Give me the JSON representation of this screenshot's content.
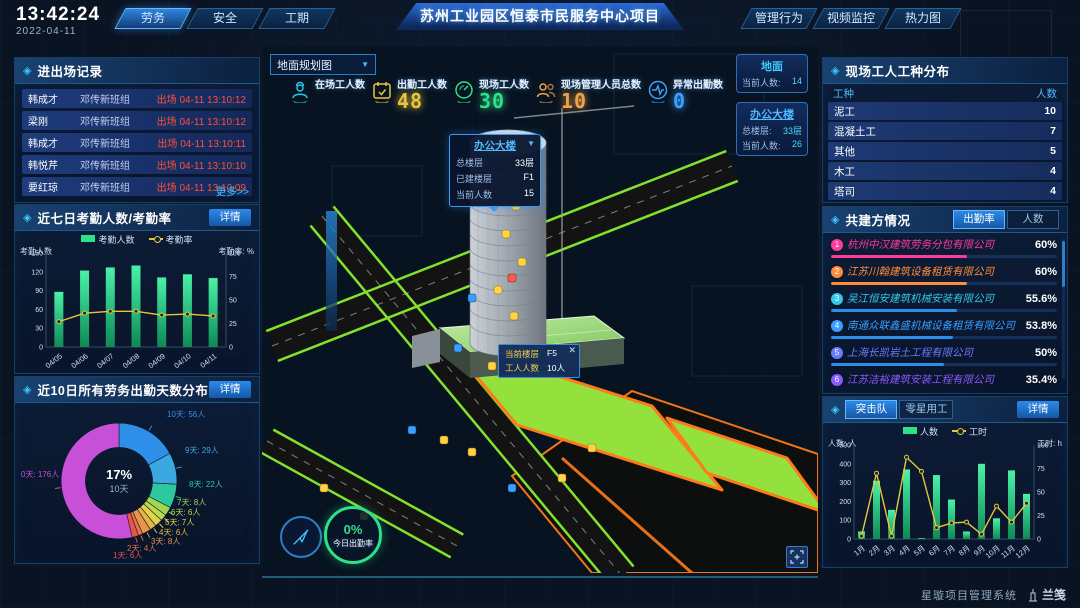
{
  "header": {
    "time": "13:42:24",
    "date": "2022-04-11",
    "left_tabs": [
      {
        "label": "劳务",
        "active": true
      },
      {
        "label": "安全",
        "active": false
      },
      {
        "label": "工期",
        "active": false
      }
    ],
    "title": "苏州工业园区恒泰市民服务中心项目",
    "right_tabs": [
      {
        "label": "管理行为"
      },
      {
        "label": "视频监控"
      },
      {
        "label": "热力图"
      }
    ]
  },
  "ui": {
    "detail_label": "详情"
  },
  "entry_exit": {
    "title": "进出场记录",
    "rows": [
      {
        "name": "韩成才",
        "group": "邓传新班组",
        "status": "出场 04-11 13:10:12"
      },
      {
        "name": "梁刚",
        "group": "邓传新班组",
        "status": "出场 04-11 13:10:12"
      },
      {
        "name": "韩成才",
        "group": "邓传新班组",
        "status": "出场 04-11 13:10:11"
      },
      {
        "name": "韩悦芹",
        "group": "邓传新班组",
        "status": "出场 04-11 13:10:10"
      },
      {
        "name": "要红琼",
        "group": "邓传新班组",
        "status": "出场 04-11 13:10:09"
      }
    ],
    "more_label": "更多>>"
  },
  "scene": {
    "view_select": "地面规划图",
    "stats": [
      {
        "label": "在场工人数",
        "value": "",
        "color": "#27c5e8"
      },
      {
        "label": "出勤工人数",
        "value": "48",
        "color": "#e8c53a"
      },
      {
        "label": "现场工人数",
        "value": "30",
        "color": "#2ee08a"
      },
      {
        "label": "现场管理人员总数",
        "value": "10",
        "color": "#f0a04a"
      },
      {
        "label": "异常出勤数",
        "value": "0",
        "color": "#3aa0ff"
      }
    ],
    "building_popup": {
      "title": "办公大楼",
      "rows": [
        [
          "总楼层",
          "33层"
        ],
        [
          "已建楼层",
          "F1"
        ],
        [
          "当前人数",
          "15"
        ]
      ]
    },
    "floor_tooltip": {
      "rows": [
        [
          "当前楼层",
          "F5"
        ],
        [
          "工人人数",
          "10人"
        ]
      ]
    },
    "overlay_cards": [
      {
        "title": "地面",
        "rows": [
          [
            "当前人数:",
            "14"
          ]
        ]
      },
      {
        "title": "办公大楼",
        "rows": [
          [
            "总楼层:",
            "33层"
          ],
          [
            "当前人数:",
            "26"
          ]
        ]
      }
    ],
    "today_rate": {
      "value": "0%",
      "label": "今日出勤率"
    }
  },
  "worker_types": {
    "title": "现场工人工种分布",
    "columns": [
      "工种",
      "人数"
    ],
    "rows": [
      [
        "泥工",
        "10"
      ],
      [
        "混凝土工",
        "7"
      ],
      [
        "其他",
        "5"
      ],
      [
        "木工",
        "4"
      ],
      [
        "塔司",
        "4"
      ]
    ]
  },
  "partners": {
    "title": "共建方情况",
    "tabs": [
      "出勤率",
      "人数"
    ],
    "active_tab": "出勤率",
    "rows": [
      {
        "rank": "1",
        "name": "杭州中汉建筑劳务分包有限公司",
        "value": "60%",
        "pct": 60,
        "color": "#ff3a9a",
        "bar": "#ff3a9a"
      },
      {
        "rank": "2",
        "name": "江苏川翰建筑设备租赁有限公司",
        "value": "60%",
        "pct": 60,
        "color": "#ff8c3a",
        "bar": "#ff8c3a"
      },
      {
        "rank": "3",
        "name": "吴江恒安建筑机械安装有限公司",
        "value": "55.6%",
        "pct": 55.6,
        "color": "#35c8e8",
        "bar": "#2a8fe8"
      },
      {
        "rank": "4",
        "name": "南通众联鑫盛机械设备租赁有限公司",
        "value": "53.8%",
        "pct": 53.8,
        "color": "#3a9fff",
        "bar": "#2a8fe8"
      },
      {
        "rank": "5",
        "name": "上海长凯岩土工程有限公司",
        "value": "50%",
        "pct": 50,
        "color": "#6a7aff",
        "bar": "#2a8fe8"
      },
      {
        "rank": "6",
        "name": "江苏洁裕建筑安装工程有限公司",
        "value": "35.4%",
        "pct": 35.4,
        "color": "#8a5aff",
        "bar": "#2a8fe8"
      }
    ]
  },
  "teams": {
    "tabs": [
      "突击队",
      "零星用工"
    ],
    "active_tab": "突击队"
  },
  "footer": {
    "system_name": "星璇项目管理系统",
    "logo_text": "兰笺"
  },
  "chart_data": [
    {
      "id": "attendance",
      "type": "bar+line",
      "title": "近七日考勤人数/考勤率",
      "categories": [
        "04/05",
        "04/06",
        "04/07",
        "04/08",
        "04/09",
        "04/10",
        "04/11"
      ],
      "series": [
        {
          "name": "考勤人数",
          "type": "bar",
          "color": "#2ee08a",
          "axis": "left",
          "values": [
            88,
            122,
            127,
            130,
            111,
            116,
            110
          ]
        },
        {
          "name": "考勤率",
          "type": "line",
          "color": "#e8c53a",
          "axis": "right",
          "values": [
            27,
            36,
            38,
            38,
            34,
            35,
            33
          ]
        }
      ],
      "left_axis": {
        "label": "考勤人数",
        "ticks": [
          0,
          30,
          60,
          90,
          120,
          150
        ],
        "max": 150
      },
      "right_axis": {
        "label": "考勤率: %",
        "ticks": [
          0,
          25,
          50,
          75,
          100
        ],
        "max": 100
      },
      "legend_position": "top"
    },
    {
      "id": "distribution",
      "type": "pie",
      "title": "近10日所有劳务出勤天数分布",
      "labels": [
        "10天",
        "9天",
        "8天",
        "7天",
        "6天",
        "5天",
        "4天",
        "3天",
        "2天",
        "1天",
        "0天"
      ],
      "values": [
        56,
        29,
        22,
        8,
        6,
        7,
        6,
        8,
        4,
        6,
        176
      ],
      "unit": "人",
      "colors": [
        "#2f8fe8",
        "#3aa9e0",
        "#2ec8a0",
        "#a0d850",
        "#c0d84a",
        "#e0d44a",
        "#e8b44a",
        "#e8944a",
        "#e8744a",
        "#e8544a",
        "#c850d8"
      ],
      "center": {
        "value": "17%",
        "label": "10天"
      }
    },
    {
      "id": "teams",
      "type": "bar+line",
      "title": "突击队",
      "categories": [
        "1月",
        "2月",
        "3月",
        "4月",
        "5月",
        "6月",
        "7月",
        "8月",
        "9月",
        "10月",
        "11月",
        "12月"
      ],
      "series": [
        {
          "name": "人数",
          "type": "bar",
          "color": "#2ee08a",
          "axis": "left",
          "values": [
            40,
            310,
            155,
            370,
            5,
            340,
            210,
            40,
            400,
            110,
            365,
            240
          ]
        },
        {
          "name": "工时",
          "type": "line",
          "color": "#e8c53a",
          "axis": "right",
          "values": [
            3,
            70,
            3,
            87,
            72,
            12,
            17,
            18,
            5,
            35,
            18,
            38
          ]
        }
      ],
      "left_axis": {
        "label": "人数: 人",
        "ticks": [
          0,
          100,
          200,
          300,
          400,
          500
        ],
        "max": 500
      },
      "right_axis": {
        "label": "工时: h",
        "ticks": [
          0,
          25,
          50,
          75,
          100
        ],
        "max": 100
      }
    }
  ]
}
